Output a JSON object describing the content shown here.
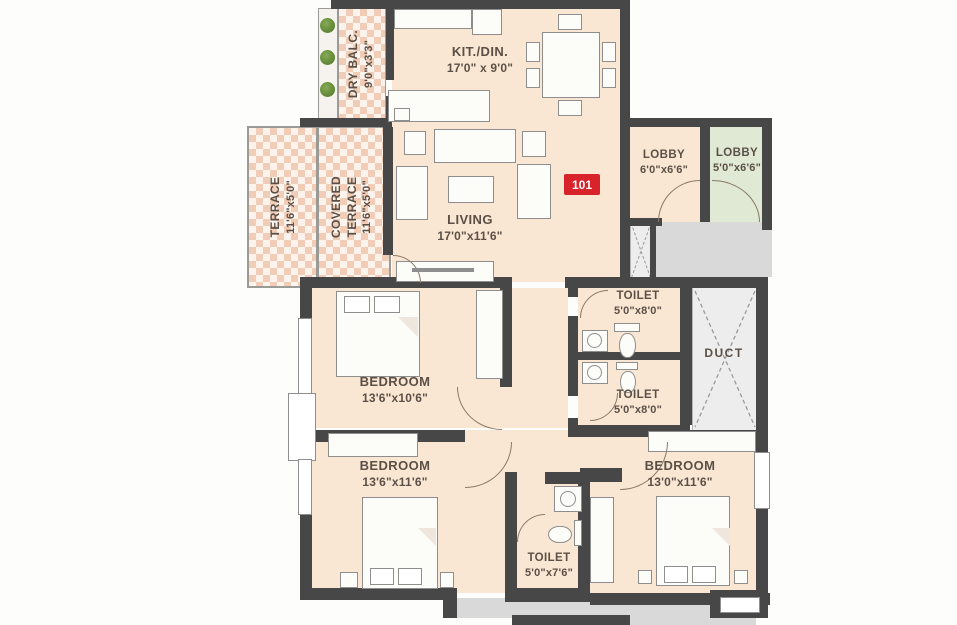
{
  "unit": {
    "number": "101"
  },
  "rooms": {
    "dry_balcony": {
      "name": "DRY BALC.",
      "dims": "9'0\"x3'3\""
    },
    "kitchen_dining": {
      "name": "KIT./DIN.",
      "dims": "17'0\" x 9'0\""
    },
    "terrace": {
      "name": "TERRACE",
      "dims": "11'6\"x5'0\""
    },
    "covered_terrace": {
      "name_line1": "COVERED",
      "name_line2": "TERRACE",
      "dims": "11'6\"x5'0\""
    },
    "living": {
      "name": "LIVING",
      "dims": "17'0\"x11'6\""
    },
    "lobby_inner": {
      "name": "LOBBY",
      "dims": "6'0\"x6'6\""
    },
    "lobby_outer": {
      "name": "LOBBY",
      "dims": "5'0\"x6'6\""
    },
    "toilet_top": {
      "name": "TOILET",
      "dims": "5'0\"x8'0\""
    },
    "toilet_mid": {
      "name": "TOILET",
      "dims": "5'0\"x8'0\""
    },
    "toilet_bottom": {
      "name": "TOILET",
      "dims": "5'0\"x7'6\""
    },
    "duct": {
      "name": "DUCT"
    },
    "bedroom_top": {
      "name": "BEDROOM",
      "dims": "13'6\"x10'6\""
    },
    "bedroom_bottom_left": {
      "name": "BEDROOM",
      "dims": "13'6\"x11'6\""
    },
    "bedroom_bottom_right": {
      "name": "BEDROOM",
      "dims": "13'0\"x11'6\""
    }
  },
  "colors": {
    "wall": "#474747",
    "floor": "#f9e6d3",
    "terrace_check": "#f1cdb7",
    "lobby_green": "#dfe9d4",
    "corridor_gray": "#d9d9d9",
    "duct_gray": "#ededed",
    "badge_red": "#d8232a",
    "label_text": "#5c5046"
  }
}
